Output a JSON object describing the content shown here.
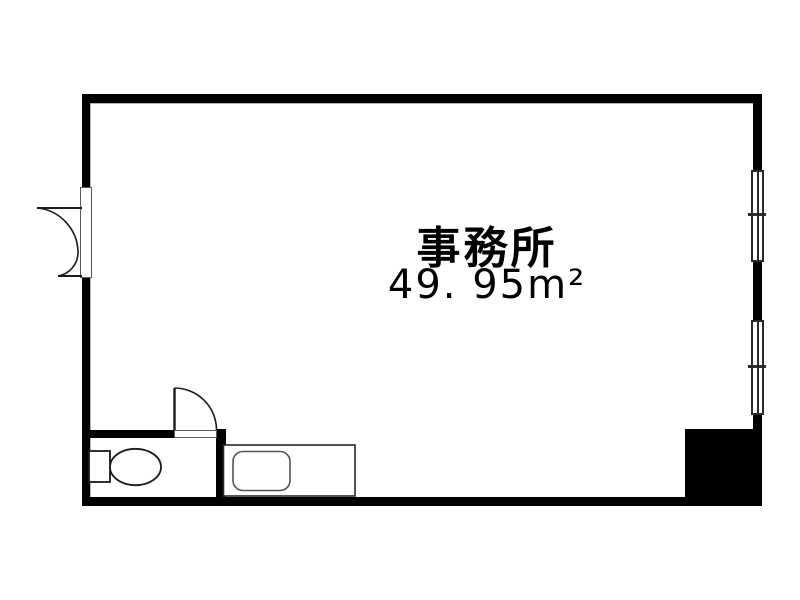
{
  "floorplan": {
    "room": {
      "name_label": "事務所",
      "area_label": "49. 95m²"
    },
    "colors": {
      "wall": "#000000",
      "thin_line": "#1a1a1a",
      "frame_line": "#5a5a5a",
      "inner_outline": "#b3b3b3",
      "text": "#000000",
      "background": "#ffffff"
    },
    "features": {
      "entry_door": "double-swing-entry-door",
      "toilet_door": "single-swing-door",
      "toilet": "toilet-with-tank",
      "kitchen": "kitchen-counter-with-sink",
      "windows": [
        "sliding-window-upper",
        "sliding-window-lower"
      ],
      "pillar": "structural-pillar"
    }
  }
}
